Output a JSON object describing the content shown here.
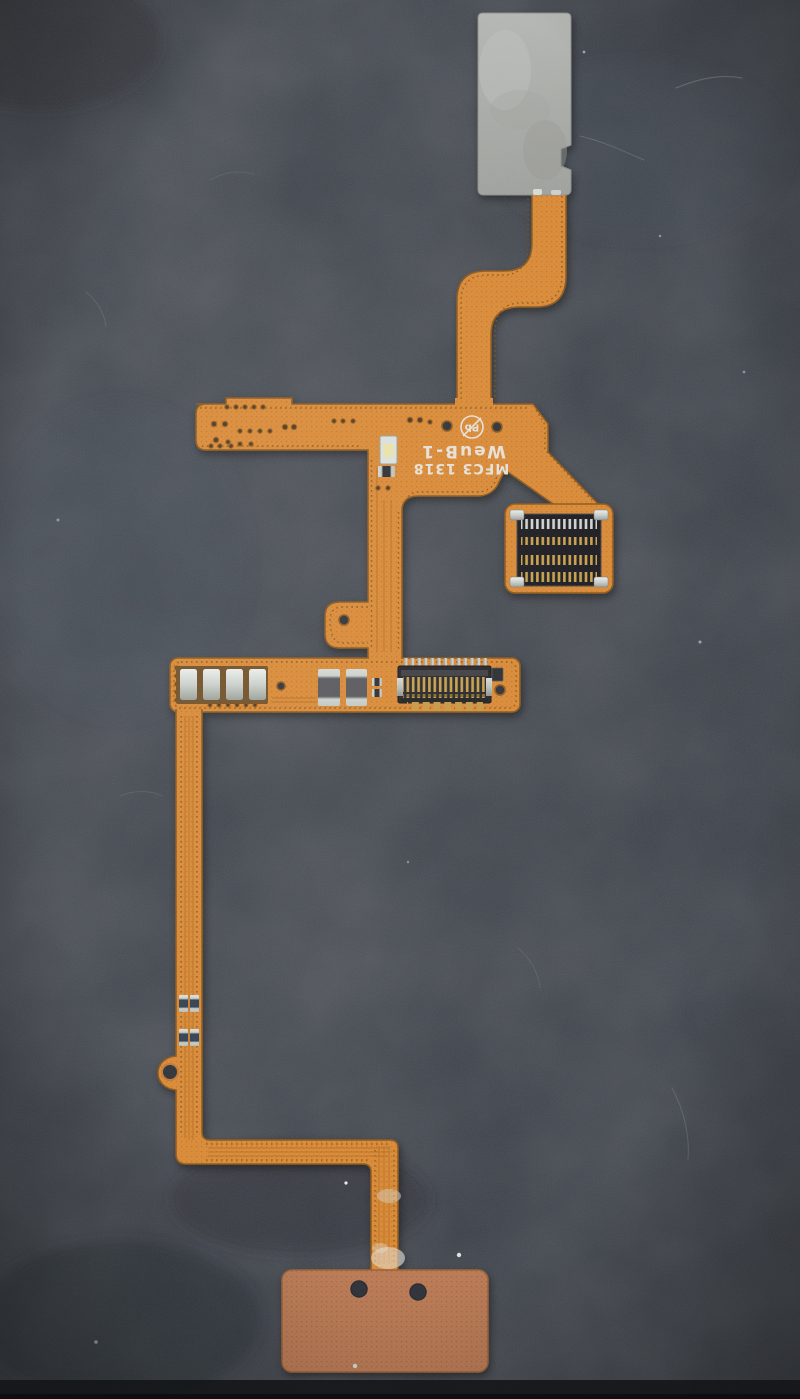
{
  "scene": {
    "subject": "Phone flex ribbon cable (flexible printed circuit) lying on a dark gray textured surface"
  },
  "silkscreen": {
    "line1": "WeuB-1",
    "line2": "MFC3 1318",
    "pb_free_symbol": "Pb",
    "orientation": "printed upside-down (rotated 180 degrees)"
  },
  "connectors": {
    "board_to_board": {
      "pin_rows": 4,
      "pins_per_row": 14
    },
    "ffc_zif": {
      "top_teeth": 13,
      "contact_stripes": 15,
      "bottom_pads": 7
    }
  },
  "components": {
    "spring_contacts": 4,
    "capacitors": 2,
    "led_count": 1,
    "small_smd_chips": 4,
    "through_holes": 6
  },
  "colors": {
    "background": "#3b4048",
    "flex_copper": "#dd8a33",
    "flex_edge": "#8a5516",
    "stiffener_gray": "#adafab",
    "bottom_pad_brown": "#bd7a52",
    "connector_body": "#1d1d22",
    "gold_pins": "#c9a04a",
    "silver": "#cdd2cd",
    "silkscreen_white": "#e9e4da"
  }
}
